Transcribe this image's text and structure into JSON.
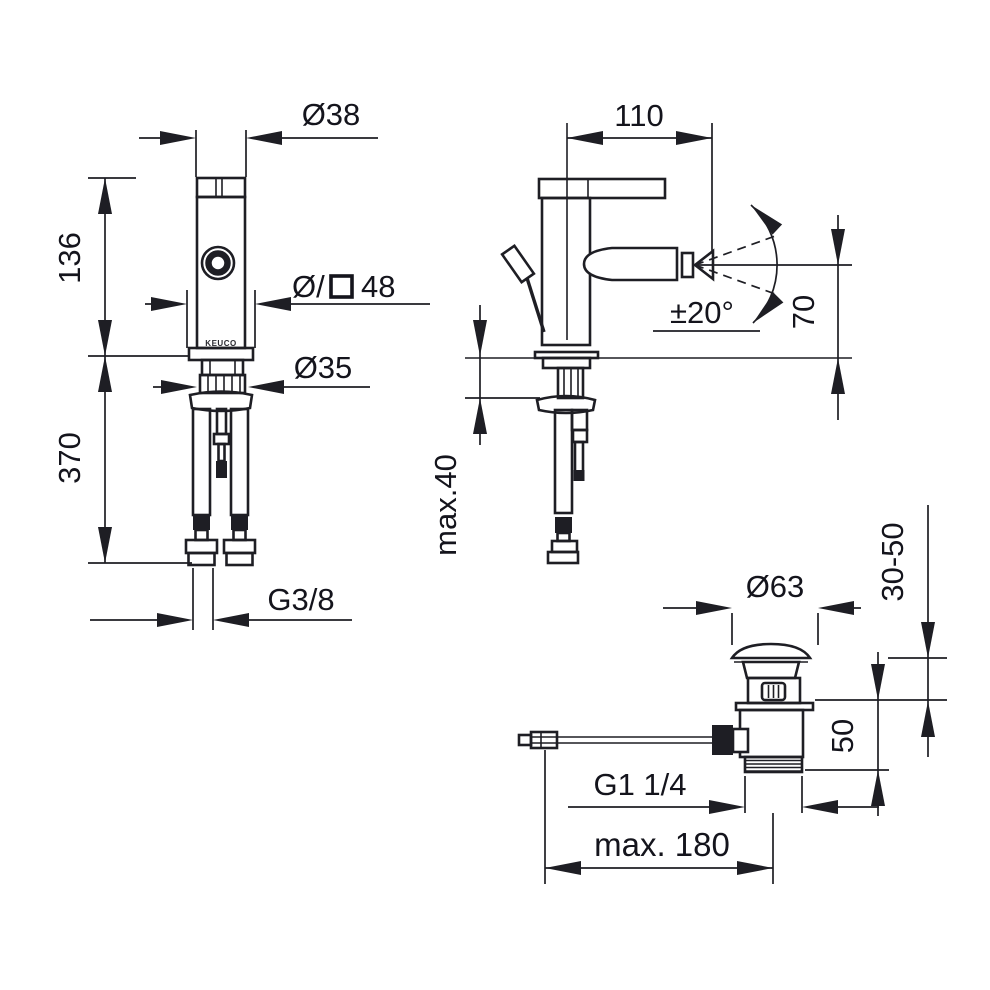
{
  "drawing": {
    "background": "#ffffff",
    "line_color": "#1e1e24",
    "text_color": "#14141c",
    "views": {
      "front": {
        "name": "bidet-fitting-front-view",
        "labels": {
          "top_diameter": "Ø38",
          "body_height": "136",
          "hose_length": "370",
          "base_prefix": "Ø/",
          "base_size": "48",
          "shank_diameter": "Ø35",
          "hose_thread": "G3/8",
          "logo": "KEUCO"
        }
      },
      "side": {
        "name": "bidet-fitting-side-view",
        "labels": {
          "spout_reach": "110",
          "swivel_angle": "±20°",
          "spout_height": "70",
          "deck_thickness": "max.40"
        }
      },
      "drain": {
        "name": "pop-up-waste-view",
        "labels": {
          "cap_diameter": "Ø63",
          "clamp_range": "30-50",
          "body_height": "50",
          "outlet_thread": "G1 1/4",
          "rod_reach": "max. 180"
        }
      }
    }
  }
}
